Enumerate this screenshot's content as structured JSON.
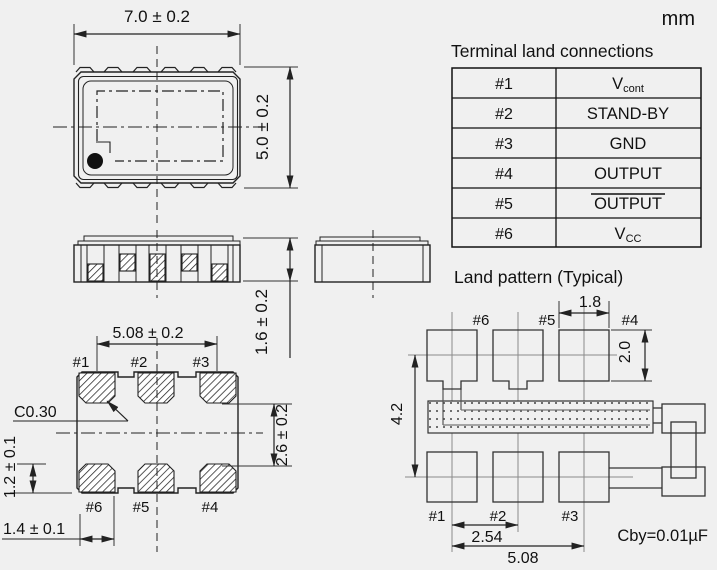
{
  "unit_label": "mm",
  "colors": {
    "background": "#f0f0f0",
    "line": "#222222",
    "centerline": "#8a8a8a"
  },
  "terminal_table": {
    "title": "Terminal land connections",
    "rows": [
      {
        "pin": "#1",
        "signal": "V",
        "signal_sub": "cont"
      },
      {
        "pin": "#2",
        "signal": "STAND-BY",
        "signal_sub": ""
      },
      {
        "pin": "#3",
        "signal": "GND",
        "signal_sub": ""
      },
      {
        "pin": "#4",
        "signal": "OUTPUT",
        "signal_sub": ""
      },
      {
        "pin": "#5",
        "signal": "OUTPUT",
        "signal_sub": "",
        "overline": true
      },
      {
        "pin": "#6",
        "signal": "V",
        "signal_sub": "CC"
      }
    ]
  },
  "top_view": {
    "width_dim": "7.0 ± 0.2",
    "height_dim": "5.0 ± 0.2"
  },
  "side_view": {
    "height_dim": "1.6 ± 0.2"
  },
  "bottom_view": {
    "span_dim": "5.08 ± 0.2",
    "chamfer_label": "C0.30",
    "pad_gap_dim": "2.6 ± 0.2",
    "pad_height_dim": "1.2 ± 0.1",
    "pad_width_dim": "1.4 ± 0.1",
    "top_pad_labels": [
      "#1",
      "#2",
      "#3"
    ],
    "bottom_pad_labels": [
      "#6",
      "#5",
      "#4"
    ]
  },
  "land_pattern": {
    "title": "Land pattern (Typical)",
    "pad_width_dim": "1.8",
    "pad_height_dim": "2.0",
    "row_pitch_dim": "4.2",
    "pad_pitch_dim": "2.54",
    "span_dim": "5.08",
    "bypass_cap_label": "Cby=0.01µF",
    "top_pad_labels": [
      "#6",
      "#5",
      "#4"
    ],
    "bottom_pad_labels": [
      "#1",
      "#2",
      "#3"
    ]
  }
}
